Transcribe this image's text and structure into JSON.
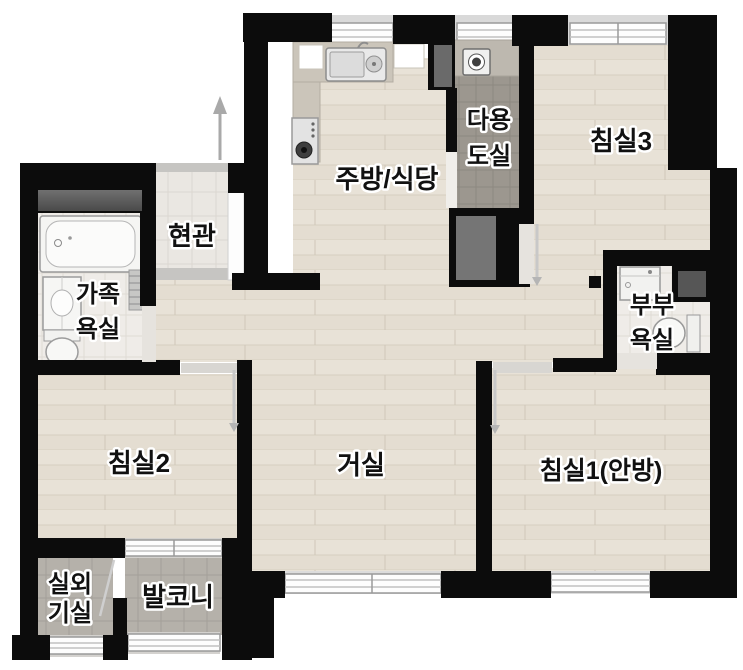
{
  "floorplan": {
    "rooms": {
      "kitchen_dining": {
        "label": "주방/식당"
      },
      "utility_room": {
        "line1": "다용",
        "line2": "도실"
      },
      "bedroom3": {
        "label": "침실3"
      },
      "entrance": {
        "label": "현관"
      },
      "family_bathroom": {
        "line1": "가족",
        "line2": "욕실"
      },
      "master_bathroom": {
        "line1": "부부",
        "line2": "욕실"
      },
      "bedroom2": {
        "label": "침실2"
      },
      "living_room": {
        "label": "거실"
      },
      "bedroom1": {
        "label": "침실1(안방)"
      },
      "outdoor_unit_room": {
        "line1": "실외",
        "line2": "기실"
      },
      "balcony": {
        "label": "발코니"
      }
    },
    "colors": {
      "wall": "#0c0c0c",
      "wood_floor": "#e8e2d7",
      "entrance_tile": "#eae7e2",
      "bathroom_tile": "#efece8",
      "balcony_tile": "#b5b1aa",
      "utility_tile": "#9c978f",
      "counter": "#cbc5ba",
      "window_frame": "#ffffff",
      "window_sill": "#d9d9d9",
      "storage_gray": "#5d5d5d",
      "label_text": "#111111",
      "label_outline": "#ffffff"
    }
  }
}
